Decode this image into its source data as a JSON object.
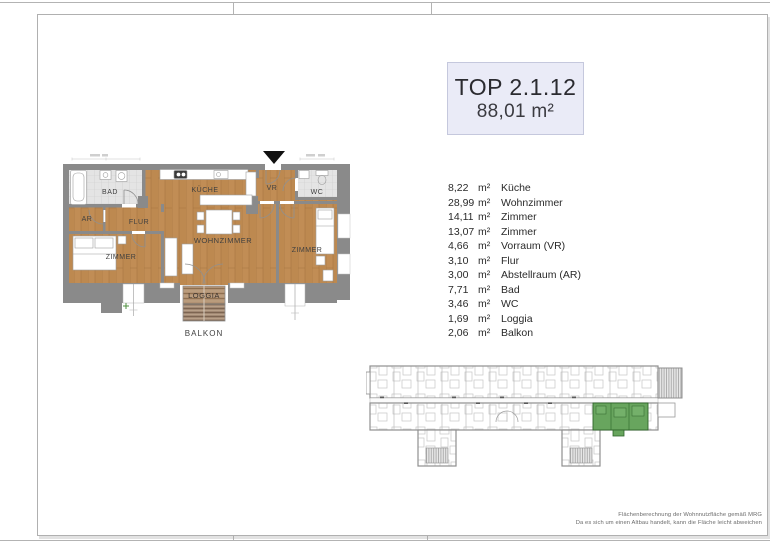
{
  "sheet": {
    "title_block": {
      "title": "TOP 2.1.12",
      "area": "88,01 m²"
    },
    "room_list": [
      {
        "area": "8,22",
        "unit": "m²",
        "name": "Küche"
      },
      {
        "area": "28,99",
        "unit": "m²",
        "name": "Wohnzimmer"
      },
      {
        "area": "14,11",
        "unit": "m²",
        "name": "Zimmer"
      },
      {
        "area": "13,07",
        "unit": "m²",
        "name": "Zimmer"
      },
      {
        "area": "4,66",
        "unit": "m²",
        "name": "Vorraum (VR)"
      },
      {
        "area": "3,10",
        "unit": "m²",
        "name": "Flur"
      },
      {
        "area": "3,00",
        "unit": "m²",
        "name": "Abstellraum (AR)"
      },
      {
        "area": "7,71",
        "unit": "m²",
        "name": "Bad"
      },
      {
        "area": "3,46",
        "unit": "m²",
        "name": "WC"
      },
      {
        "area": "1,69",
        "unit": "m²",
        "name": "Loggia"
      },
      {
        "area": "2,06",
        "unit": "m²",
        "name": "Balkon"
      }
    ],
    "floor_plan": {
      "labels": {
        "bad": "BAD",
        "kueche": "KÜCHE",
        "vr": "VR",
        "wc": "WC",
        "ar": "AR",
        "flur": "FLUR",
        "zimmer_left": "ZIMMER",
        "wohnzimmer": "WOHNZIMMER",
        "zimmer_right": "ZIMMER",
        "loggia": "LOGGIA",
        "balkon": "BALKON"
      }
    },
    "disclaimer": {
      "line1": "Flächenberechnung der Wohnnutzfläche gemäß MRG",
      "line2": "Da es sich um einen Altbau handelt, kann die Fläche leicht abweichen"
    }
  },
  "colors": {
    "highlight_green": "#68a55e",
    "wood_floor": "#c18d55",
    "wall_gray": "#8a8a8a",
    "tile_gray": "#e4e4e4",
    "title_block_bg": "#eaebf7",
    "deck_brown": "#b29274"
  }
}
